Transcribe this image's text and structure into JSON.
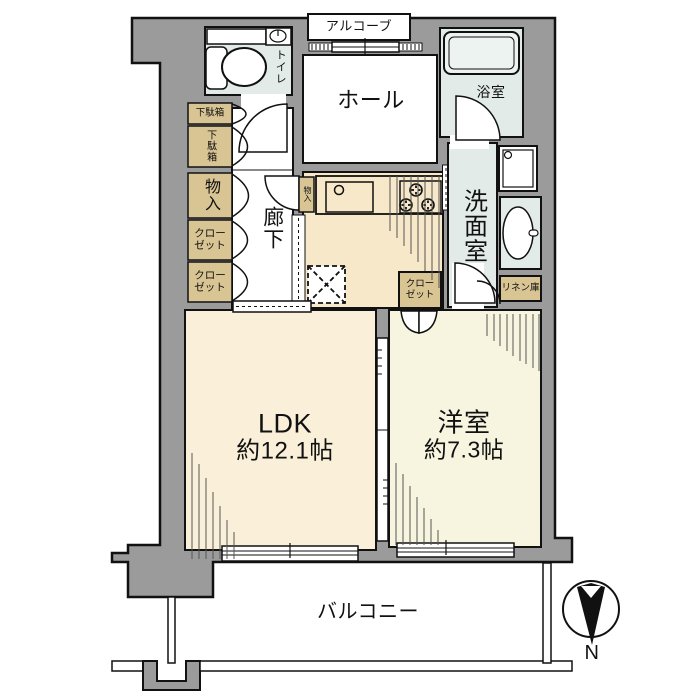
{
  "labels": {
    "alcove": "アルコーブ",
    "toilet": "トイレ",
    "hall": "ホール",
    "bathroom": "浴室",
    "washroom": "洗面室",
    "linen_closet": "リネン庫",
    "shoe_cabinet_top": "下駄箱",
    "shoe_cabinet_bottom": "下駄箱",
    "storage_left": "物入",
    "closet_left_1": "クローゼット",
    "closet_left_2": "クローゼット",
    "corridor": "廊下",
    "storage_kitchen": "物入",
    "closet_west_room": "クローゼット",
    "balcony": "バルコニー",
    "compass_north": "N"
  },
  "rooms": {
    "ldk": {
      "name": "LDK",
      "size": "約12.1帖"
    },
    "western_room": {
      "name": "洋室",
      "size": "約7.3帖"
    }
  },
  "colors": {
    "wall": "#9B9B9B",
    "water_room": "#E2EBE8",
    "tub": "#EDF3F1",
    "kitchen_floor": "#F6E8C8",
    "ldk_floor": "#FAF0D9",
    "western_room_floor": "#F7F5E0",
    "cabinet": "#D9C493",
    "outline": "#111111"
  }
}
